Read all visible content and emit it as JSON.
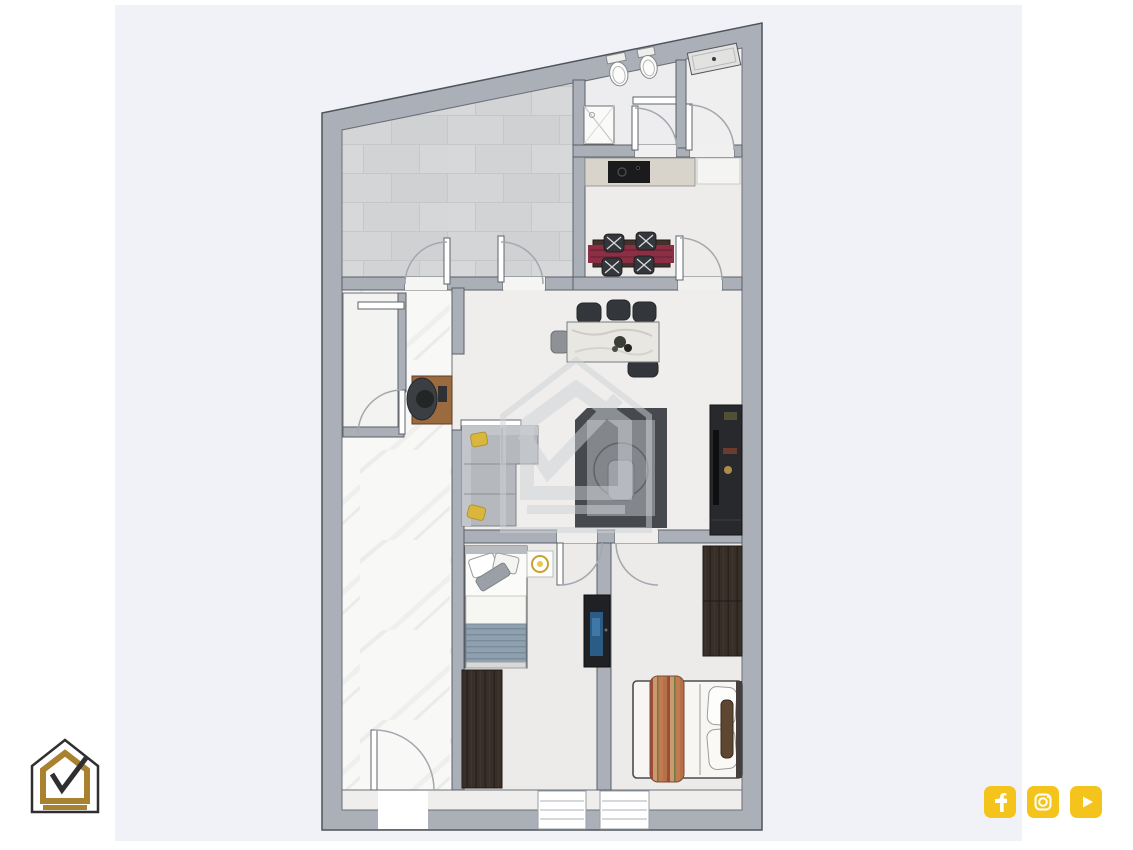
{
  "canvas": {
    "width": 1133,
    "height": 850,
    "background": "#ffffff"
  },
  "panel": {
    "background": "#f1f2f7"
  },
  "palette": {
    "wall": "#abb0b8",
    "wall_line": "#5a5f66",
    "floor": "#efeeec",
    "floor_bath": "#ededef",
    "floor_hall": "#efeff0",
    "floor_kitchen": "#edecea",
    "floor_bedroom": "#ecebe9",
    "floor_small_room": "#f3f3f1",
    "counter": "#d8d4cc",
    "counter_mat": "#f4f4f2",
    "cooktop": "#1b1b1d",
    "table_wood": "#43322b",
    "runner_red": "#8c2f44",
    "chair_dark": "#33363b",
    "chair_gray": "#8e9296",
    "island_top": "#e9e7e2",
    "sofa": "#b5b8bc",
    "sofa_back": "#c2c5c9",
    "pillow_yellow": "#d9b73e",
    "rug_dark": "#46494e",
    "rug_mid": "#83868b",
    "rug_light": "#9ea1a6",
    "tv_unit": "#27292c",
    "desk_wood": "#9b6a3f",
    "bed_white": "#fbfbf9",
    "blanket_blue": "#8fa0af",
    "wardrobe": "#38302a",
    "tv_panel": "#1f2124",
    "tv_screen": "#2b5c86",
    "bolster_brown": "#5e4631",
    "fixture_white": "#fcfcfa"
  },
  "watermark": {
    "color": "#cfd2d8"
  },
  "logo": {
    "outline": "#2f2f2f",
    "gold": "#a9822f",
    "fill": "#ffffff"
  },
  "social": {
    "color": "#f5c41c",
    "items": [
      {
        "name": "facebook",
        "glyph": "f"
      },
      {
        "name": "instagram",
        "glyph": ""
      },
      {
        "name": "youtube",
        "glyph": ""
      }
    ]
  }
}
